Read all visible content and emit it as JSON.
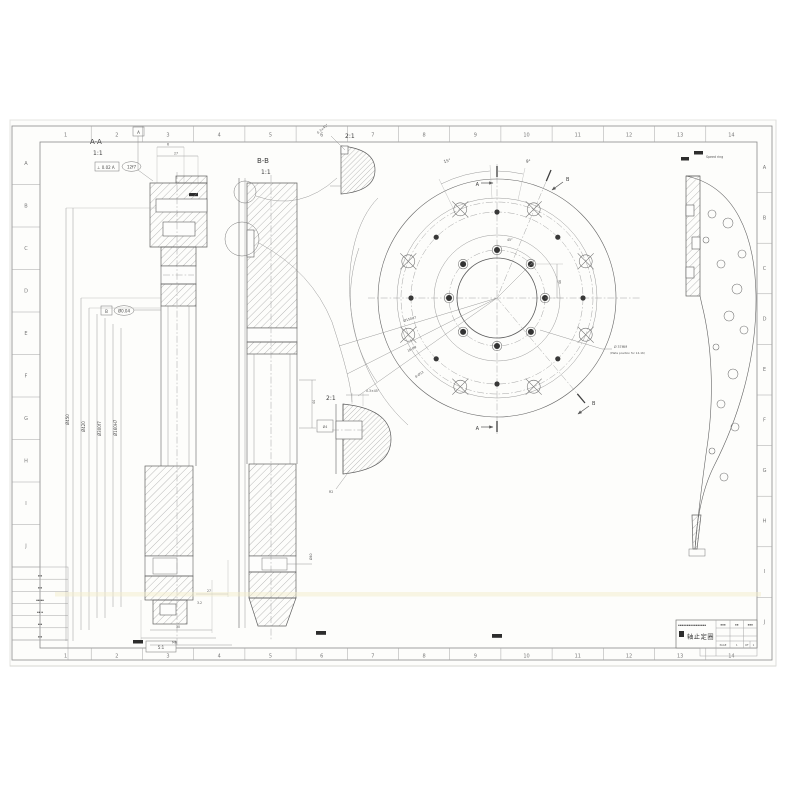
{
  "sheet": {
    "grid_cols": [
      "1",
      "2",
      "3",
      "4",
      "5",
      "6",
      "7",
      "8",
      "9",
      "10",
      "11",
      "12",
      "13",
      "14"
    ],
    "grid_rows": [
      "A",
      "B",
      "C",
      "D",
      "E",
      "F",
      "G",
      "H",
      "I",
      "J"
    ],
    "fold_stamp": "5:1"
  },
  "views": {
    "section_aa": {
      "label": "A-A",
      "scale": "1:1"
    },
    "section_bb": {
      "label": "B-B",
      "scale": "1:1"
    },
    "detail_top": {
      "scale": "2:1",
      "chamfer": "0.3×45°"
    },
    "detail_mid": {
      "scale": "2:1",
      "chamfer": "0.3×45°",
      "radius": "R2",
      "bore": "Ø4"
    },
    "front": {
      "cut_label_a": "A",
      "cut_label_b": "B",
      "angle1": "15°",
      "angle2": "9°",
      "angle3": "45°",
      "dim_right": "48",
      "lead1": "Ø150H7",
      "lead2": "16-Ø9",
      "lead3": "8-Ø12",
      "note_line1": "Ø 37MM",
      "note_line2": "(Plate position for 14-16)"
    },
    "right_view": {
      "note": "Speed ring"
    }
  },
  "dims": {
    "datum_a": "A",
    "datum_b": "B",
    "gdt_top": "⊥ 0.02 A",
    "gdt_oval_top": "12f7",
    "gdt_oval_mid": "Ø0.04",
    "aa_top_w": "6",
    "aa_top_w2": "27",
    "aa_slot": "Ø10",
    "aa_b1": "27",
    "aa_b2": "30",
    "aa_b3": "M6",
    "aa_fin": "3.2",
    "bb_slot": "Ø40",
    "bb_r": "44",
    "left_phi1": "Ø450",
    "left_phi2": "Ø420",
    "left_phi3": "Ø300f7",
    "left_phi4": "Ø160H7"
  },
  "title_block": {
    "company": "▪▪▪▪▪▪▪▪▪▪▪▪▪▪▪▪",
    "title": "轴止定圈",
    "col1": "▪▪▪",
    "col2": "▪▪",
    "col3": "▪▪▪",
    "page_label": "PAGE",
    "page_no": "1",
    "of_label": "OF",
    "of_no": "1"
  },
  "revision_table": {
    "rows": [
      "▪ ▪",
      "▪ ▪",
      "▪▪ ▪▪",
      "▪▪ ▪",
      "▪ ▪",
      "▪ ▪"
    ]
  }
}
